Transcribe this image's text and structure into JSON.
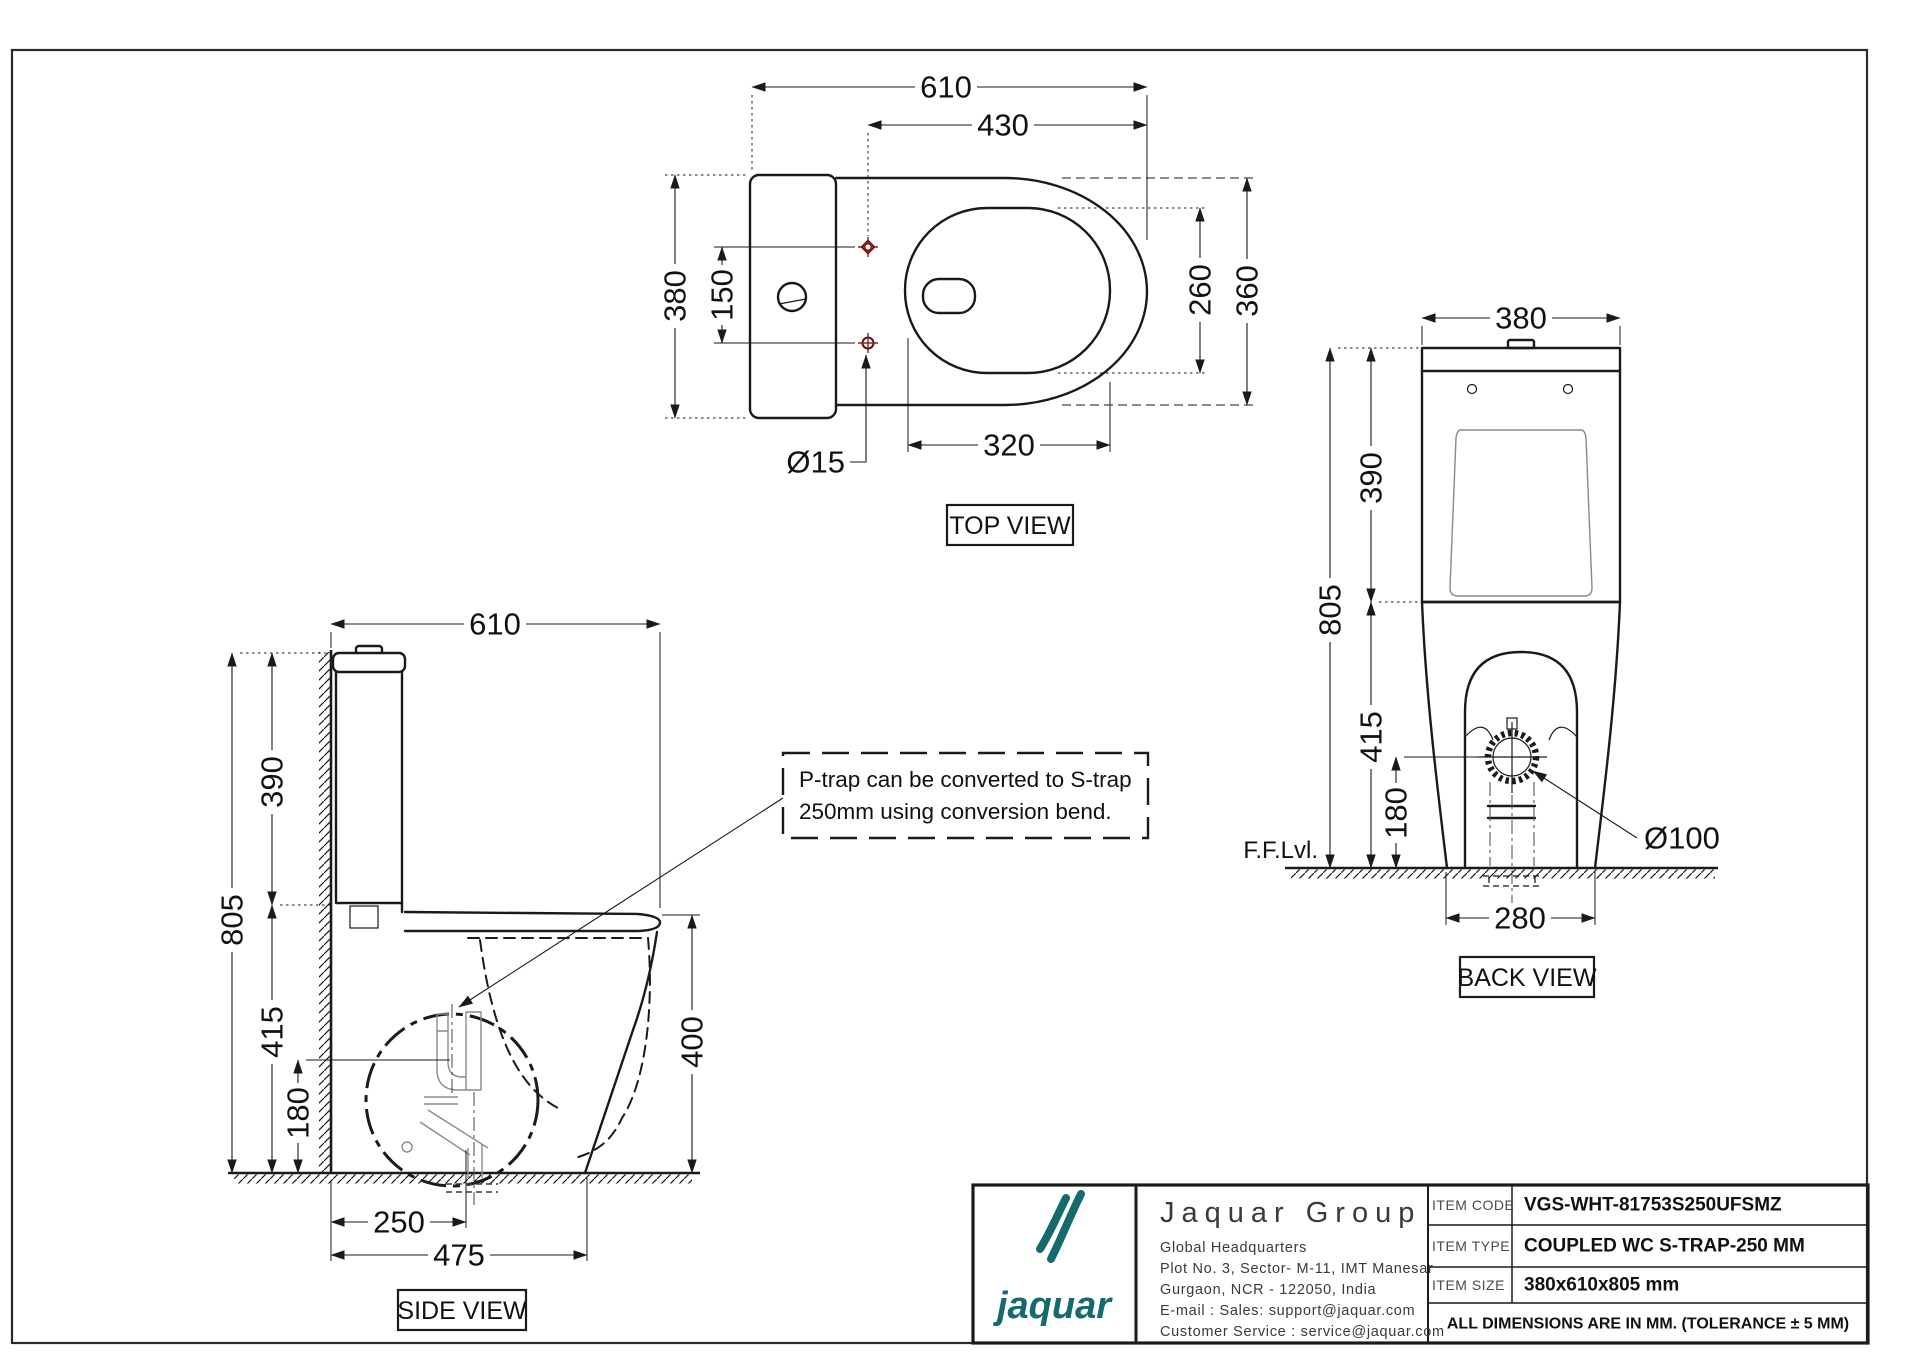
{
  "sheet": {
    "line_color": "#1a1a1a",
    "accent_red": "#8b1e1e",
    "brand_teal": "#156a6e"
  },
  "top_view": {
    "label": "TOP VIEW",
    "dims": {
      "overall_width": "610",
      "front_to_holes": "430",
      "overall_depth": "380",
      "hole_spacing": "150",
      "bowl_inner": "260",
      "bowl_outer": "360",
      "bowl_width": "320",
      "hole_dia": "Ø15"
    }
  },
  "side_view": {
    "label": "SIDE VIEW",
    "note_line1": "P-trap can be converted to S-trap",
    "note_line2": "250mm using conversion bend.",
    "dims": {
      "overall_length": "610",
      "cistern_height": "390",
      "overall_height": "805",
      "pan_height": "415",
      "trap_center_height": "180",
      "trap_offset": "250",
      "base_length": "475",
      "rim_height": "400"
    }
  },
  "back_view": {
    "label": "BACK VIEW",
    "floor_label": "F.F.Lvl.",
    "dims": {
      "overall_width": "380",
      "cistern_height": "390",
      "overall_height": "805",
      "pan_height": "415",
      "trap_center_height": "180",
      "base_width": "280",
      "outlet_dia": "Ø100"
    }
  },
  "title_block": {
    "logo_text": "jaquar",
    "company": "Jaquar Group",
    "hq": "Global Headquarters",
    "address1": "Plot No. 3, Sector- M-11, IMT Manesar",
    "address2": "Gurgaon, NCR - 122050, India",
    "email": "E-mail : Sales: support@jaquar.com",
    "service": "Customer Service : service@jaquar.com",
    "rows": [
      {
        "label": "ITEM CODE",
        "value": "VGS-WHT-81753S250UFSMZ"
      },
      {
        "label": "ITEM TYPE",
        "value": "COUPLED WC S-TRAP-250 MM"
      },
      {
        "label": "ITEM SIZE",
        "value": "380x610x805 mm"
      }
    ],
    "tolerance_note": "ALL DIMENSIONS ARE IN MM. (TOLERANCE ± 5 MM)"
  }
}
